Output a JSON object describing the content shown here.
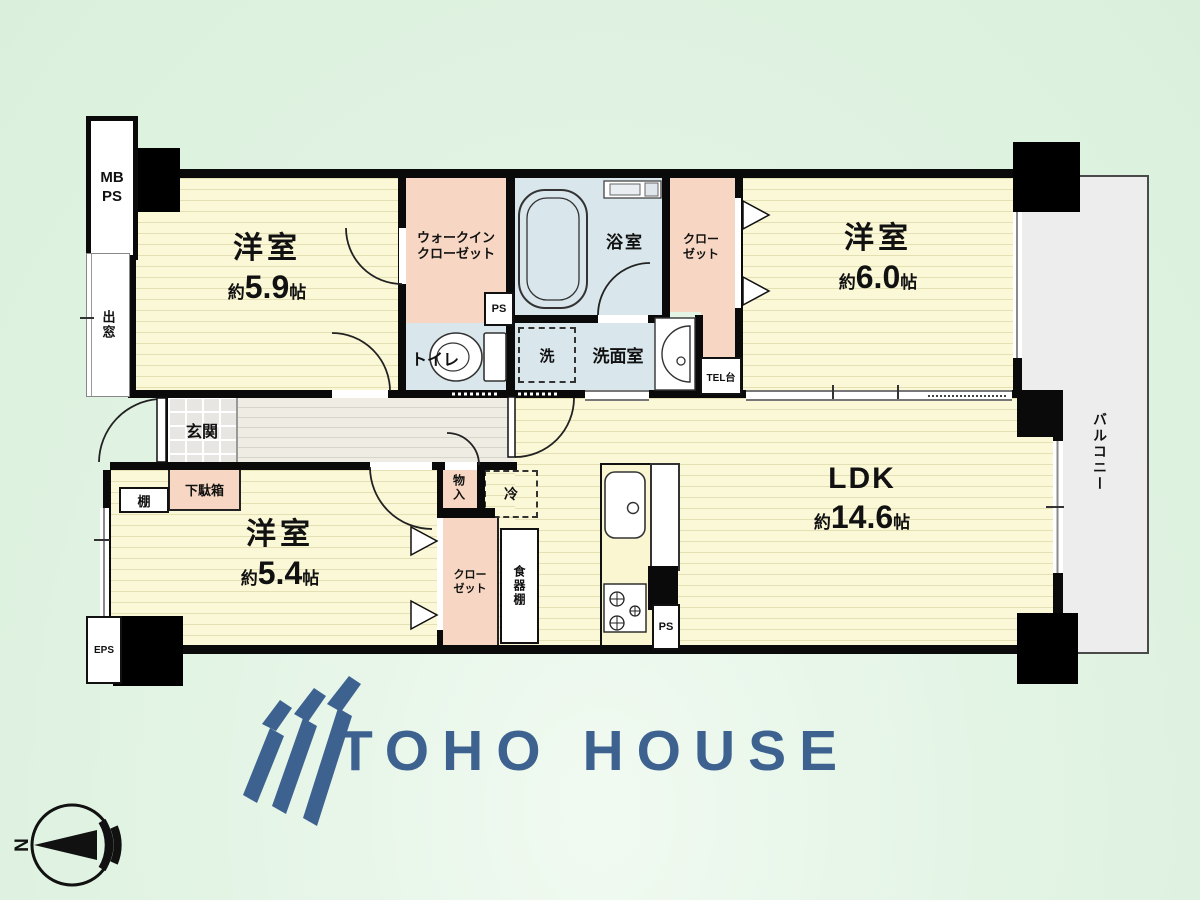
{
  "colors": {
    "logo_blue": "#3e6290",
    "wall_black": "#0a0a0a",
    "room_yellow": "#fbf8d8",
    "closet_pink": "#f7d7c3",
    "water_blue": "#d9e6ec",
    "balcony_grey": "#ededed",
    "background_green": "#e3f4e5"
  },
  "rooms": {
    "bedroom1": {
      "name": "洋室",
      "approx": "約",
      "num": "5.9",
      "unit": "帖"
    },
    "bedroom2": {
      "name": "洋室",
      "approx": "約",
      "num": "6.0",
      "unit": "帖"
    },
    "bedroom3": {
      "name": "洋室",
      "approx": "約",
      "num": "5.4",
      "unit": "帖"
    },
    "ldk": {
      "name": "LDK",
      "approx": "約",
      "num": "14.6",
      "unit": "帖"
    },
    "wic": {
      "line1": "ウォークイン",
      "line2": "クローゼット"
    },
    "closet_top": {
      "line1": "クロー",
      "line2": "ゼット"
    },
    "closet_bottom": {
      "line1": "クロー",
      "line2": "ゼット"
    },
    "bath": "浴室",
    "washroom": "洗面室",
    "washer": "洗",
    "toilet": "トイレ",
    "entrance": "玄関",
    "shoe_cabinet": "下駄箱",
    "shelf": "棚",
    "storage": "物入",
    "fridge": "冷",
    "dish_cabinet": "食器棚",
    "balcony": "バルコニー",
    "bay_window": "出窓",
    "tel_stand": "TEL台",
    "mb": "MB",
    "ps_meter": "PS",
    "ps_wic": "PS",
    "ps_kitchen": "PS",
    "eps": "EPS"
  },
  "logo": {
    "text": "TOHO HOUSE"
  },
  "compass": {
    "north": "N"
  }
}
